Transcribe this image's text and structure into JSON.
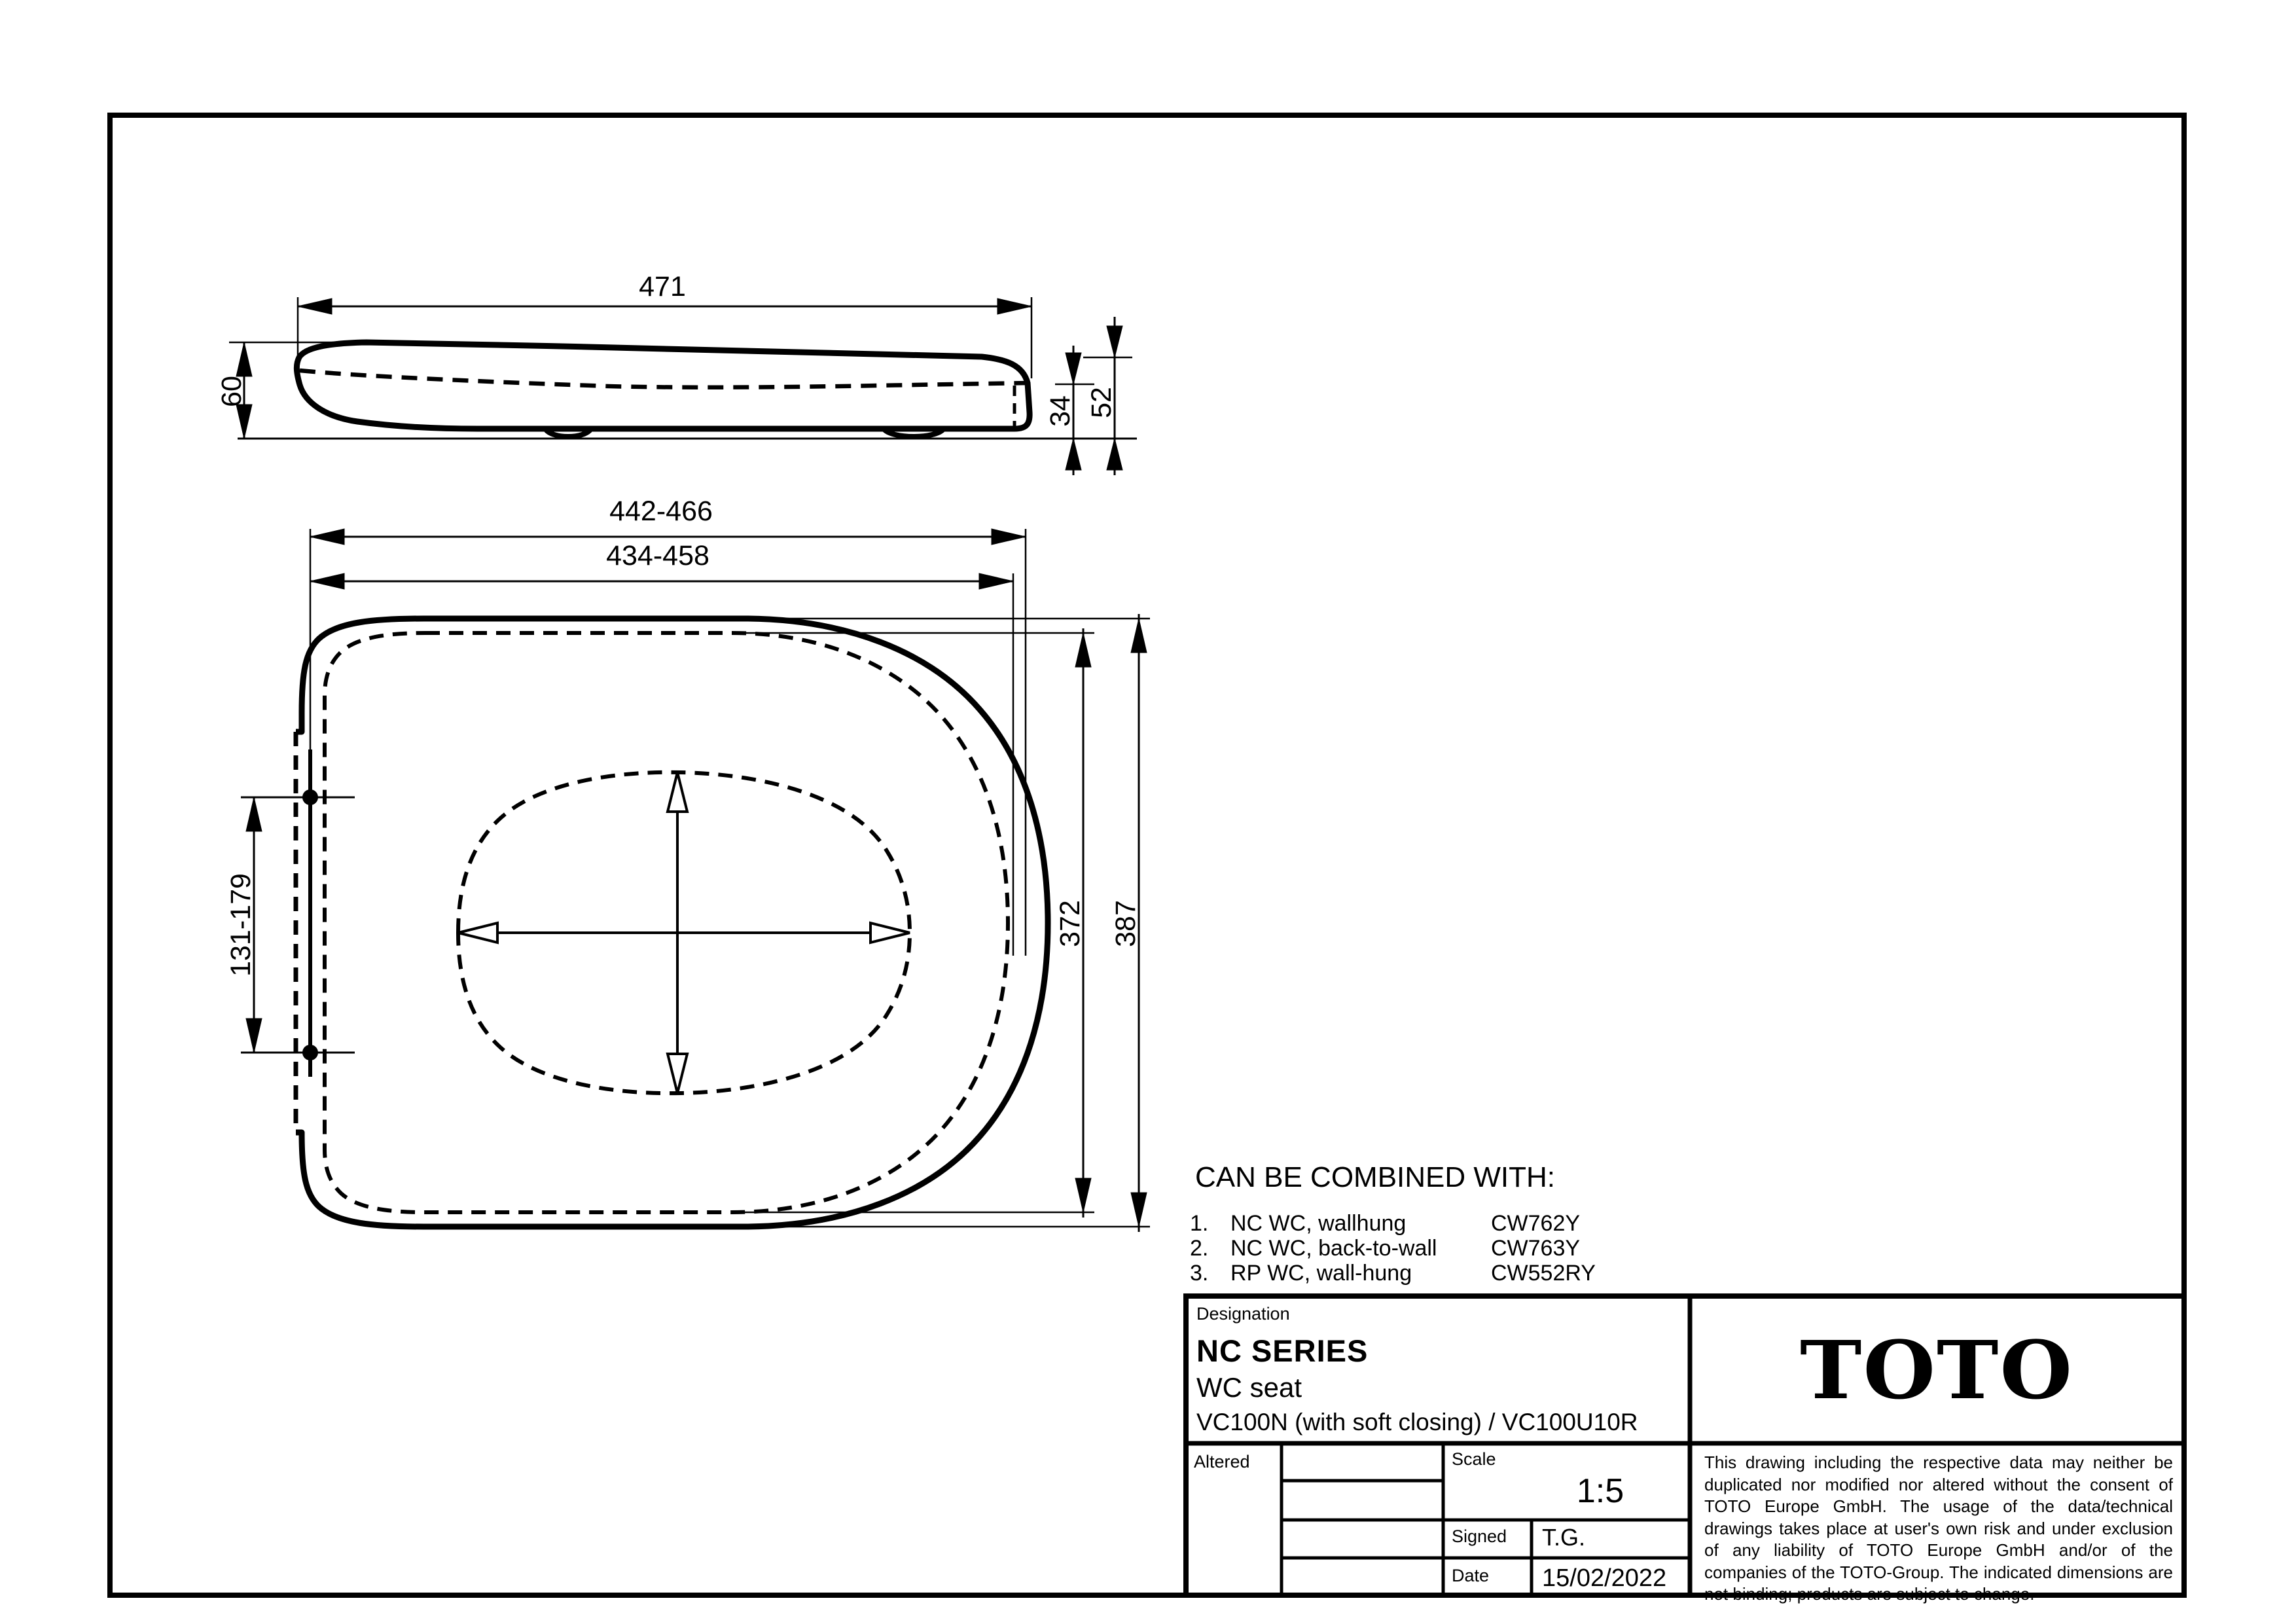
{
  "sheet": {
    "paper_color": "#ffffff",
    "ink_color": "#000000"
  },
  "side_view": {
    "dim_length": "471",
    "dim_height": "60",
    "dim_seat_height": "34",
    "dim_rear_height": "52"
  },
  "top_view": {
    "dim_length_outer": "442-466",
    "dim_length_inner": "434-458",
    "dim_hinge_span": "131-179",
    "dim_width_inner": "372",
    "dim_width_outer": "387"
  },
  "combined": {
    "title": "CAN BE COMBINED WITH:",
    "items": [
      {
        "no": "1.",
        "label": "NC WC, wallhung",
        "code": "CW762Y"
      },
      {
        "no": "2.",
        "label": "NC WC, back-to-wall",
        "code": "CW763Y"
      },
      {
        "no": "3.",
        "label": "RP WC, wall-hung",
        "code": "CW552RY"
      }
    ]
  },
  "title_block": {
    "designation_label": "Designation",
    "series": "NC SERIES",
    "product": "WC seat",
    "variants": "VC100N (with soft closing) / VC100U10R",
    "altered_label": "Altered",
    "scale_label": "Scale",
    "scale_value": "1:5",
    "signed_label": "Signed",
    "signed_value": "T.G.",
    "date_label": "Date",
    "date_value": "15/02/2022",
    "brand": "TOTO",
    "disclaimer": "This drawing including the respective data may neither be duplicated nor modified nor altered without the consent of TOTO Europe GmbH. The usage of the data/technical drawings takes place at user's own risk and under exclusion of any liability of TOTO Europe GmbH and/or of the companies of the TOTO-Group. The indicated dimensions are not binding; products are subject to change."
  }
}
